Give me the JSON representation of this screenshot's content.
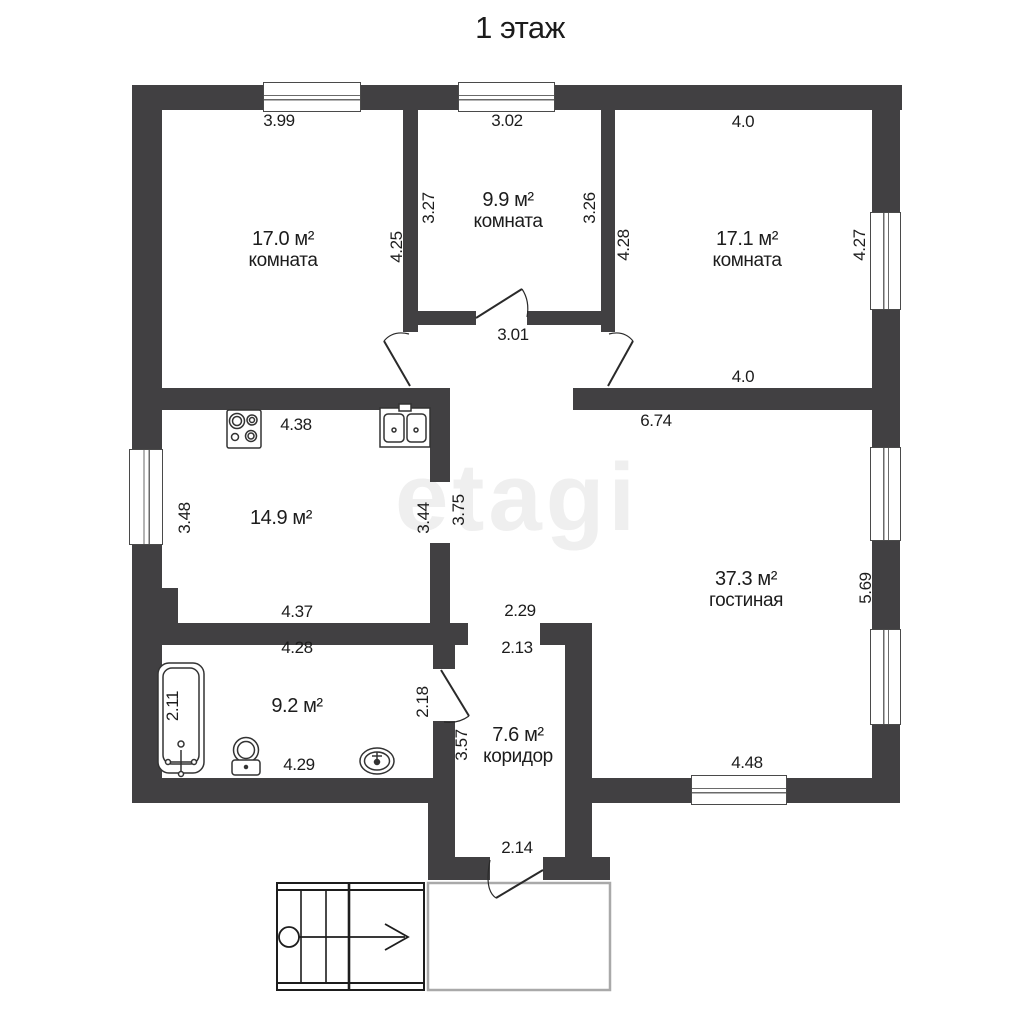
{
  "title": "1 этаж",
  "watermark": "etagi",
  "rooms": {
    "room1": {
      "area": "17.0 м²",
      "name": "комната"
    },
    "room2": {
      "area": "9.9 м²",
      "name": "комната"
    },
    "room3": {
      "area": "17.1 м²",
      "name": "комната"
    },
    "kitchen": {
      "area": "14.9 м²"
    },
    "living": {
      "area": "37.3 м²",
      "name": "гостиная"
    },
    "bath": {
      "area": "9.2 м²"
    },
    "corridor": {
      "area": "7.6 м²",
      "name": "коридор"
    }
  },
  "dims": {
    "room1_top": "3.99",
    "room2_top": "3.02",
    "room3_top": "4.0",
    "room2_left": "3.27",
    "room2_right": "3.26",
    "room1_right": "4.25",
    "room3_left": "4.28",
    "room3_right": "4.27",
    "hall_width": "3.01",
    "room3_bottom": "4.0",
    "kitchen_top": "4.38",
    "living_top": "6.74",
    "kitchen_left": "3.48",
    "kitchen_right": "3.44",
    "living_left": "3.75",
    "living_right": "5.69",
    "kitchen_bottom": "4.37",
    "passage_top": "2.29",
    "corridor_top": "2.13",
    "bath_top": "4.28",
    "bath_left": "2.11",
    "bath_door": "2.18",
    "corridor_left": "3.57",
    "bath_bottom": "4.29",
    "living_bottom": "4.48",
    "entry_door": "2.14"
  },
  "colors": {
    "wall": "#414042",
    "text": "#1c1c1c",
    "watermark": "#efefef"
  }
}
